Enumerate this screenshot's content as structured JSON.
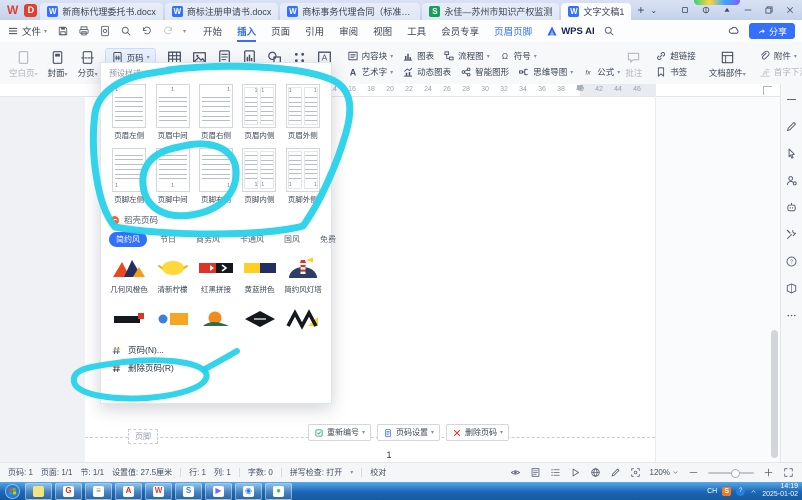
{
  "app": {
    "accent": "#3370ff",
    "annotation_color": "#26d2ea"
  },
  "titlebar": {
    "wps_logo": "W",
    "docer_logo": "D",
    "tabs": [
      {
        "icon": "wps-doc",
        "label": "新商标代理委托书.docx",
        "active": false
      },
      {
        "icon": "wps-doc",
        "label": "商标注册申请书.docx",
        "active": false
      },
      {
        "icon": "wps-doc",
        "label": "商标事务代理合同（标准）.d",
        "active": false
      },
      {
        "icon": "stock-app",
        "label": "永佳—苏州市知识产权监测",
        "active": false
      },
      {
        "icon": "wps-doc",
        "label": "文字文稿1",
        "active": true
      }
    ],
    "new_tab_label": "+"
  },
  "menubar": {
    "file_label": "文件",
    "tabs": [
      {
        "label": "开始",
        "state": "normal"
      },
      {
        "label": "插入",
        "state": "active"
      },
      {
        "label": "页面",
        "state": "normal"
      },
      {
        "label": "引用",
        "state": "normal"
      },
      {
        "label": "审阅",
        "state": "normal"
      },
      {
        "label": "视图",
        "state": "normal"
      },
      {
        "label": "工具",
        "state": "normal"
      },
      {
        "label": "会员专享",
        "state": "normal"
      },
      {
        "label": "页眉页脚",
        "state": "context"
      }
    ],
    "ai_label": "WPS AI",
    "share_label": "分享"
  },
  "ribbon": {
    "insert_group": [
      {
        "label": "空白页",
        "icon": "blank-page",
        "disabled": true
      },
      {
        "label": "封面",
        "icon": "cover-page",
        "disabled": false
      },
      {
        "label": "分页",
        "icon": "page-break",
        "disabled": false
      }
    ],
    "page_number_button": {
      "label": "页码",
      "icon": "page-number"
    },
    "big_buttons": [
      {
        "icon": "table",
        "name": "table"
      },
      {
        "icon": "picture",
        "name": "picture"
      },
      {
        "icon": "content-doc",
        "name": "document"
      },
      {
        "icon": "chart-doc",
        "name": "chart-document"
      },
      {
        "icon": "shapes",
        "name": "shapes"
      },
      {
        "icon": "icon-grid",
        "name": "icon-library"
      },
      {
        "icon": "textbox",
        "name": "textbox"
      }
    ],
    "row1": [
      {
        "label": "内容块",
        "icon": "content-block",
        "arrow": true
      },
      {
        "label": "图表",
        "icon": "chart",
        "arrow": false
      },
      {
        "label": "流程图",
        "icon": "flowchart",
        "arrow": true
      },
      {
        "label": "符号",
        "icon": "omega",
        "arrow": true
      }
    ],
    "row2": [
      {
        "label": "艺术字",
        "icon": "wordart",
        "arrow": true
      },
      {
        "label": "动态图表",
        "icon": "dyn-chart",
        "arrow": false
      },
      {
        "label": "智能图形",
        "icon": "smartart",
        "arrow": false
      },
      {
        "label": "思维导图",
        "icon": "mindmap",
        "arrow": true
      },
      {
        "label": "公式",
        "icon": "formula",
        "arrow": true
      }
    ],
    "right_group": {
      "comment": {
        "label": "批注",
        "icon": "comment",
        "disabled": true
      },
      "links": [
        {
          "label": "超链接",
          "icon": "hyperlink"
        },
        {
          "label": "书签",
          "icon": "bookmark"
        }
      ],
      "doc_parts": {
        "label": "文档部件",
        "icon": "doc-parts",
        "arrow": true
      },
      "attach": [
        {
          "label": "附件",
          "icon": "attachment",
          "arrow": true,
          "disabled": false
        },
        {
          "label": "首字下沉",
          "icon": "dropcap",
          "arrow": false,
          "disabled": true
        }
      ],
      "more": {
        "label": "更多素材",
        "icon": "more-materials",
        "arrow": true
      }
    }
  },
  "panel": {
    "header": "预设样式",
    "presets": [
      {
        "label": "页眉左侧",
        "kind": "h-left"
      },
      {
        "label": "页眉中间",
        "kind": "h-center"
      },
      {
        "label": "页眉右侧",
        "kind": "h-right"
      },
      {
        "label": "页眉内侧",
        "kind": "h-inside"
      },
      {
        "label": "页眉外侧",
        "kind": "h-outside"
      },
      {
        "label": "页脚左侧",
        "kind": "f-left"
      },
      {
        "label": "页脚中间",
        "kind": "f-center"
      },
      {
        "label": "页脚右侧",
        "kind": "f-right"
      },
      {
        "label": "页脚内侧",
        "kind": "f-inside"
      },
      {
        "label": "页脚外侧",
        "kind": "f-outside"
      }
    ],
    "docer": {
      "title": "稻壳页码",
      "tabs": [
        {
          "label": "简约风",
          "active": true
        },
        {
          "label": "节日",
          "active": false
        },
        {
          "label": "商务风",
          "active": false
        },
        {
          "label": "卡通风",
          "active": false
        },
        {
          "label": "国风",
          "active": false
        },
        {
          "label": "免费",
          "active": false
        }
      ],
      "row1": [
        {
          "label": "几何风橙色",
          "art": "geo-orange"
        },
        {
          "label": "清新柠檬",
          "art": "lemon"
        },
        {
          "label": "红黑拼接",
          "art": "red-black"
        },
        {
          "label": "黄蓝拼色",
          "art": "yellow-blue"
        },
        {
          "label": "简约风灯塔",
          "art": "lighthouse"
        }
      ],
      "row2": [
        {
          "art": "black-red"
        },
        {
          "art": "blue-orange"
        },
        {
          "art": "sunset"
        },
        {
          "art": "diamond"
        },
        {
          "art": "zigzag"
        }
      ]
    },
    "menu": [
      {
        "label": "页码(N)...",
        "icon": "hash-color"
      },
      {
        "label": "删除页码(R)",
        "icon": "hash-del"
      }
    ]
  },
  "ruler": {
    "start": 14,
    "end": 46,
    "step": 2
  },
  "document": {
    "footer_tag": "页脚",
    "footer_buttons": [
      {
        "label": "重新编号",
        "icon": "renumber",
        "arrow": true
      },
      {
        "label": "页码设置",
        "icon": "page-setup",
        "arrow": true
      },
      {
        "label": "删除页码",
        "icon": "delete-x",
        "arrow": true
      }
    ],
    "page_number": "1"
  },
  "sidebar_tools": [
    "min-line",
    "pen",
    "cursor",
    "user-gear",
    "robot",
    "tools",
    "help",
    "feedback",
    "dots"
  ],
  "statusbar": {
    "left": [
      "页码: 1",
      "页面: 1/1",
      "节: 1/1",
      "设置值: 27.5厘米",
      "行: 1",
      "列: 1",
      "字数: 0",
      "拼写检查: 打开",
      "校对"
    ],
    "zoom": "120%"
  },
  "taskbar": {
    "apps": [
      {
        "name": "sticky-notes",
        "glyph": "",
        "color": "#f7e37b"
      },
      {
        "name": "g-app",
        "glyph": "G",
        "color": "#d93025"
      },
      {
        "name": "notepad",
        "glyph": "≡",
        "color": "#8a7f5c"
      },
      {
        "name": "pdf-reader",
        "glyph": "A",
        "color": "#d92d27"
      },
      {
        "name": "wps",
        "glyph": "W",
        "color": "#e03e2d"
      },
      {
        "name": "sogou-browser",
        "glyph": "S",
        "color": "#2a7de1"
      },
      {
        "name": "media-app",
        "glyph": "▶",
        "color": "#7b61ff"
      },
      {
        "name": "browser-globe",
        "glyph": "◉",
        "color": "#2a7de1"
      },
      {
        "name": "wechat",
        "glyph": "●",
        "color": "#3ec63e"
      }
    ],
    "tray": {
      "lang": "CH",
      "input": "S",
      "time": "14:19",
      "date": "2025-01-02"
    }
  }
}
